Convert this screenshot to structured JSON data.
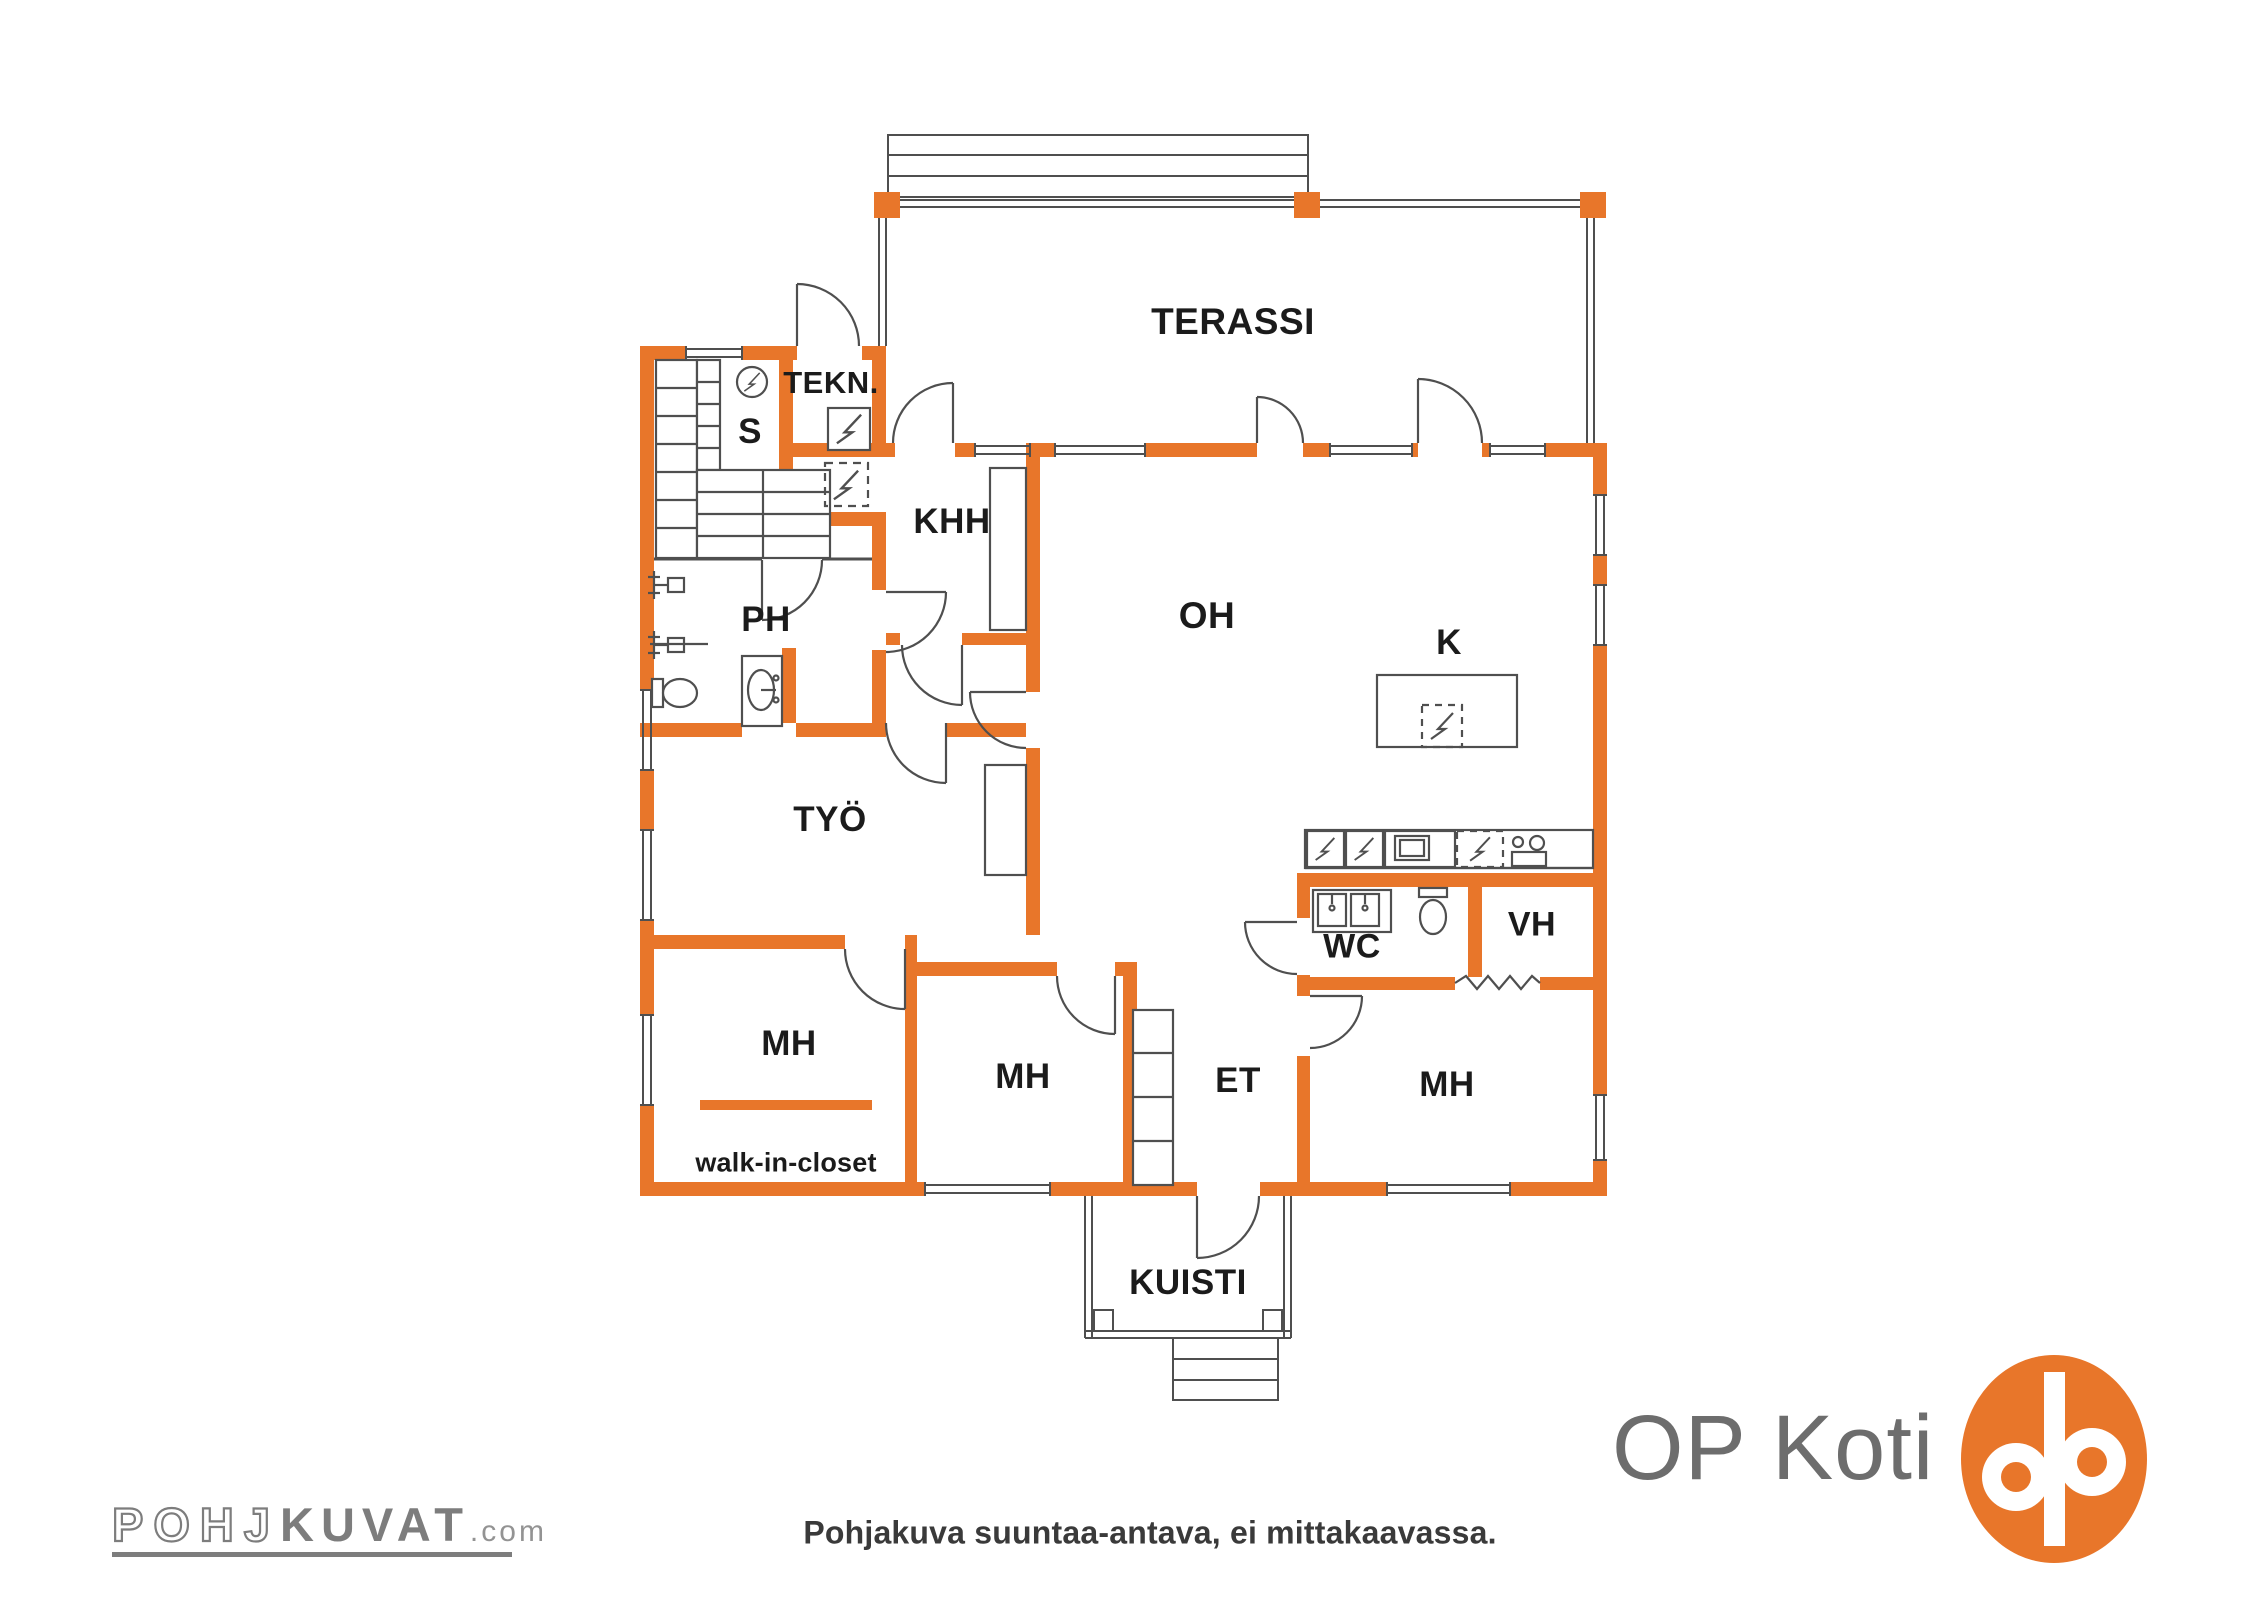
{
  "colors": {
    "wall": "#e8762a",
    "line": "#4f4f4f",
    "label": "#1b1b1b",
    "brand_gray": "#7d7d7d",
    "op_text": "#6d6d6d"
  },
  "rooms": {
    "terassi": "TERASSI",
    "tekn": "TEKN.",
    "sauna": "S",
    "khh": "KHH",
    "ph": "PH",
    "oh": "OH",
    "kitchen": "K",
    "tyo": "TYÖ",
    "wc": "WC",
    "vh": "VH",
    "mh_closet": "MH",
    "mh_middle": "MH",
    "mh_right": "MH",
    "et": "ET",
    "kuisti": "KUISTI",
    "walk_in_closet": "walk-in-closet"
  },
  "footer": {
    "disclaimer": "Pohjakuva suuntaa-antava, ei mittakaavassa."
  },
  "branding": {
    "pohjakuvat": {
      "part1": "POHJ",
      "part2": "KUVAT",
      "suffix": ".com"
    },
    "op_koti": {
      "text": "OP Koti"
    }
  }
}
